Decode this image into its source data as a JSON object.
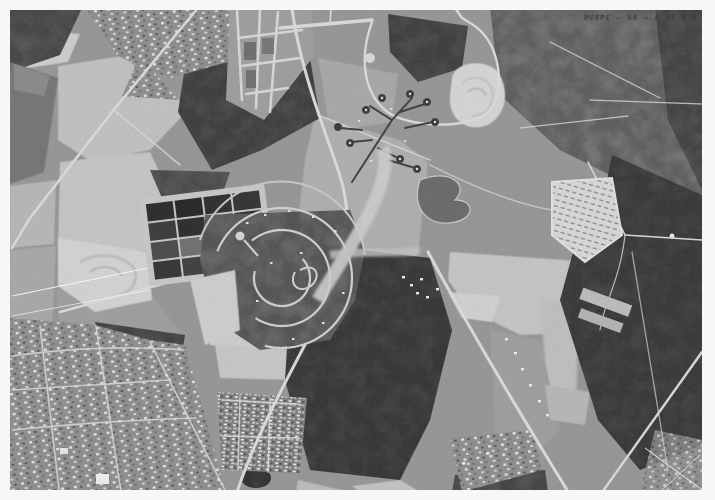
{
  "photo": {
    "reference_label": "DVRPC – 60 – A 37 B B"
  },
  "colors": {
    "frame": "#f7f7f5",
    "photo_base": "#979797",
    "woods_dark": "#4c4c4c",
    "field_light": "#c9c9c9",
    "road_light": "#dcdcdc",
    "basin_dark": "#2e2e2e",
    "water_gray": "#757575",
    "label_text": "#3c3c3c"
  }
}
